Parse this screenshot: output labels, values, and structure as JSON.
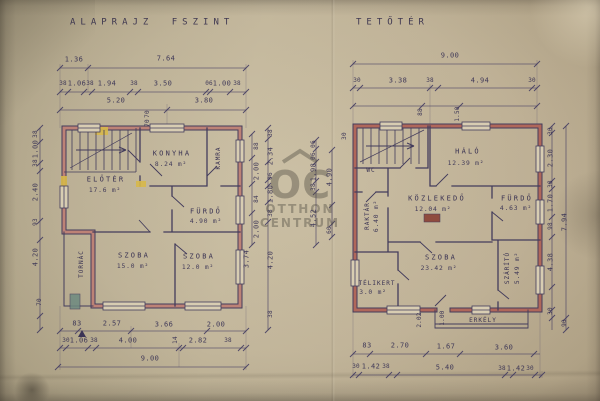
{
  "watermark": {
    "logo": "OC",
    "line1": "OTTHON",
    "line2": "CENTRUM"
  },
  "plan_left": {
    "title": "ALAPRAJZ FSZINT",
    "rooms": {
      "eloter": {
        "name": "ELŐTÉR",
        "area": "17.6 m²"
      },
      "konyha": {
        "name": "KONYHA",
        "area": "8.24 m²"
      },
      "kamra": {
        "name": "KAMRA"
      },
      "furdo": {
        "name": "FÜRDŐ",
        "area": "4.90 m²"
      },
      "szoba1": {
        "name": "SZOBA",
        "area": "15.0 m²"
      },
      "szoba2": {
        "name": "SZOBA",
        "area": "12.0 m²"
      },
      "tornac": {
        "name": "TORNÁC"
      }
    },
    "dims": {
      "top1": [
        "1.36",
        "7.64"
      ],
      "top2": [
        "38",
        "1.06",
        "38",
        "1.94",
        "38",
        "3.50",
        "06",
        "1.00",
        "38"
      ],
      "top3": [
        "5.20",
        "3.80"
      ],
      "top_small": [
        "70",
        "70"
      ],
      "bottom1": [
        "83",
        "2.57",
        "3.66",
        "2.00"
      ],
      "bottom2": [
        "30",
        "1.06",
        "38",
        "4.00",
        "14",
        "2.82",
        "38"
      ],
      "total": "9.00",
      "left": [
        "38",
        "1.00",
        "38",
        "2.40",
        "93",
        "4.20",
        "70"
      ],
      "right_a": [
        "3.74"
      ],
      "right_b": [
        "88",
        "2.00",
        "84",
        "2.00"
      ],
      "right_c": [
        "38",
        "2.34",
        "06",
        "1.80",
        "38",
        "4.20",
        "38"
      ]
    }
  },
  "plan_right": {
    "title": "TETŐTÉR",
    "rooms": {
      "halo": {
        "name": "HÁLÓ",
        "area": "12.39 m²"
      },
      "wc": {
        "name": "WC"
      },
      "kozlekedo": {
        "name": "KÖZLEKEDŐ",
        "area": "12.04 m²"
      },
      "furdo": {
        "name": "FÜRDŐ",
        "area": "4.63 m²"
      },
      "raktar": {
        "name": "RAKTÁR",
        "area": "6.40 m²"
      },
      "telikert": {
        "name": "TÉLIKERT",
        "area": "3.0 m²"
      },
      "szoba": {
        "name": "SZOBA",
        "area": "23.42 m²"
      },
      "szarito": {
        "name": "SZÁRÍTÓ",
        "area": "5.49 m²"
      },
      "erkely": {
        "name": "ERKÉLY"
      }
    },
    "dims": {
      "total": "9.00",
      "top2": [
        "30",
        "3.38",
        "38",
        "4.94",
        "30"
      ],
      "top_small": [
        "88",
        "1.50"
      ],
      "bottom1": [
        "83",
        "2.70",
        "1.67",
        "3.60"
      ],
      "bottom2": [
        "30",
        "1.42",
        "38",
        "5.40",
        "38",
        "1.42",
        "30"
      ],
      "bottom_small": [
        "2.02",
        "1.00"
      ],
      "right_a": [
        "30",
        "2.30",
        "38",
        "1.70",
        "98",
        "4.38",
        "30"
      ],
      "right_b": [
        "7.94",
        "90"
      ],
      "left_a": [
        "06",
        "06",
        "1.98",
        "38",
        "4.52"
      ],
      "left_b": [
        "4.90",
        "60"
      ],
      "left_c": [
        "30"
      ]
    }
  }
}
